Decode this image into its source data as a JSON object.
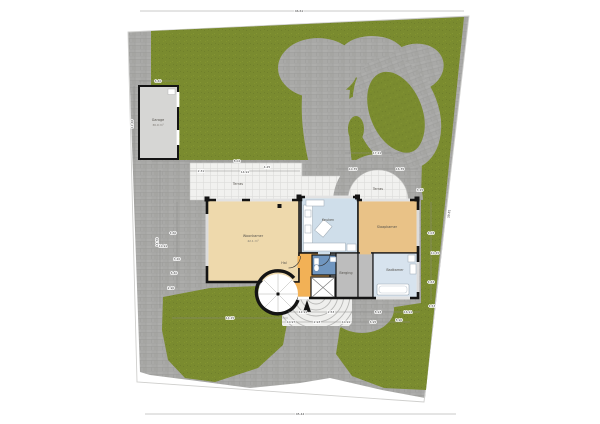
{
  "plan": {
    "type": "site-floor-plan",
    "rooms": [
      {
        "id": "woonkamer",
        "label": "Woonkamer",
        "area": "42.1 m²",
        "x": 253,
        "y": 237
      },
      {
        "id": "keuken",
        "label": "Keuken",
        "area": "",
        "x": 328,
        "y": 221
      },
      {
        "id": "slaapkamer",
        "label": "Slaapkamer",
        "area": "",
        "x": 387,
        "y": 228
      },
      {
        "id": "hal",
        "label": "Hal",
        "area": "",
        "x": 284,
        "y": 264
      },
      {
        "id": "badkamer",
        "label": "Badkamer",
        "area": "",
        "x": 395,
        "y": 271
      },
      {
        "id": "berging",
        "label": "Berging",
        "area": "",
        "x": 346,
        "y": 274
      },
      {
        "id": "terras-achter",
        "label": "Terras",
        "area": "",
        "x": 378,
        "y": 190
      },
      {
        "id": "terras-voor",
        "label": "Terras",
        "area": "",
        "x": 238,
        "y": 185
      },
      {
        "id": "garage",
        "label": "Garage",
        "area": "30.9 m²",
        "x": 158,
        "y": 121
      }
    ],
    "dimensions": [
      {
        "t": "46.61",
        "x": 299,
        "y": 11
      },
      {
        "t": "45.44",
        "x": 300,
        "y": 414
      },
      {
        "t": "6.40",
        "x": 158,
        "y": 81
      },
      {
        "t": "11.40",
        "x": 133,
        "y": 123,
        "r": -90
      },
      {
        "t": "14.50",
        "x": 158,
        "y": 241,
        "r": -90
      },
      {
        "t": "4.60",
        "x": 173,
        "y": 233
      },
      {
        "t": "10.91",
        "x": 163,
        "y": 246
      },
      {
        "t": "3.20",
        "x": 177,
        "y": 259
      },
      {
        "t": "6.40",
        "x": 174,
        "y": 273
      },
      {
        "t": "2.90",
        "x": 171,
        "y": 288
      },
      {
        "t": "8.02",
        "x": 237,
        "y": 161
      },
      {
        "t": "4.25",
        "x": 267,
        "y": 167
      },
      {
        "t": "2.31",
        "x": 201,
        "y": 171
      },
      {
        "t": "14.91",
        "x": 245,
        "y": 172
      },
      {
        "t": "17.21",
        "x": 377,
        "y": 153
      },
      {
        "t": "10.35",
        "x": 353,
        "y": 169
      },
      {
        "t": "16.35",
        "x": 400,
        "y": 169
      },
      {
        "t": "3.15",
        "x": 420,
        "y": 190
      },
      {
        "t": "4.03",
        "x": 431,
        "y": 233
      },
      {
        "t": "10.45",
        "x": 435,
        "y": 253
      },
      {
        "t": "4.63",
        "x": 431,
        "y": 282
      },
      {
        "t": "39.81",
        "x": 450,
        "y": 213,
        "r": -84
      },
      {
        "t": "11.91",
        "x": 303,
        "y": 312
      },
      {
        "t": "2.53",
        "x": 331,
        "y": 312
      },
      {
        "t": "8.93",
        "x": 378,
        "y": 312
      },
      {
        "t": "16.91",
        "x": 408,
        "y": 312
      },
      {
        "t": "10.97",
        "x": 291,
        "y": 322
      },
      {
        "t": "2.93",
        "x": 317,
        "y": 322
      },
      {
        "t": "10.91",
        "x": 346,
        "y": 322
      },
      {
        "t": "6.95",
        "x": 373,
        "y": 322
      },
      {
        "t": "8.90",
        "x": 399,
        "y": 320
      },
      {
        "t": "14.25",
        "x": 230,
        "y": 318
      },
      {
        "t": "4.53",
        "x": 432,
        "y": 306
      }
    ],
    "colors": {
      "paving": "#a9a9a7",
      "grass": "#7a8b2f",
      "tile": "#f1f1ef",
      "wall": "#141414",
      "living": "#eed9ac",
      "kitchen": "#cfdeea",
      "bedroom": "#e9c287",
      "hall": "#f2b156",
      "bathroom": "#d7e3ee",
      "toilet": "#7096c0",
      "storage": "#bdbdbd",
      "garage": "#d6d6d4"
    }
  }
}
